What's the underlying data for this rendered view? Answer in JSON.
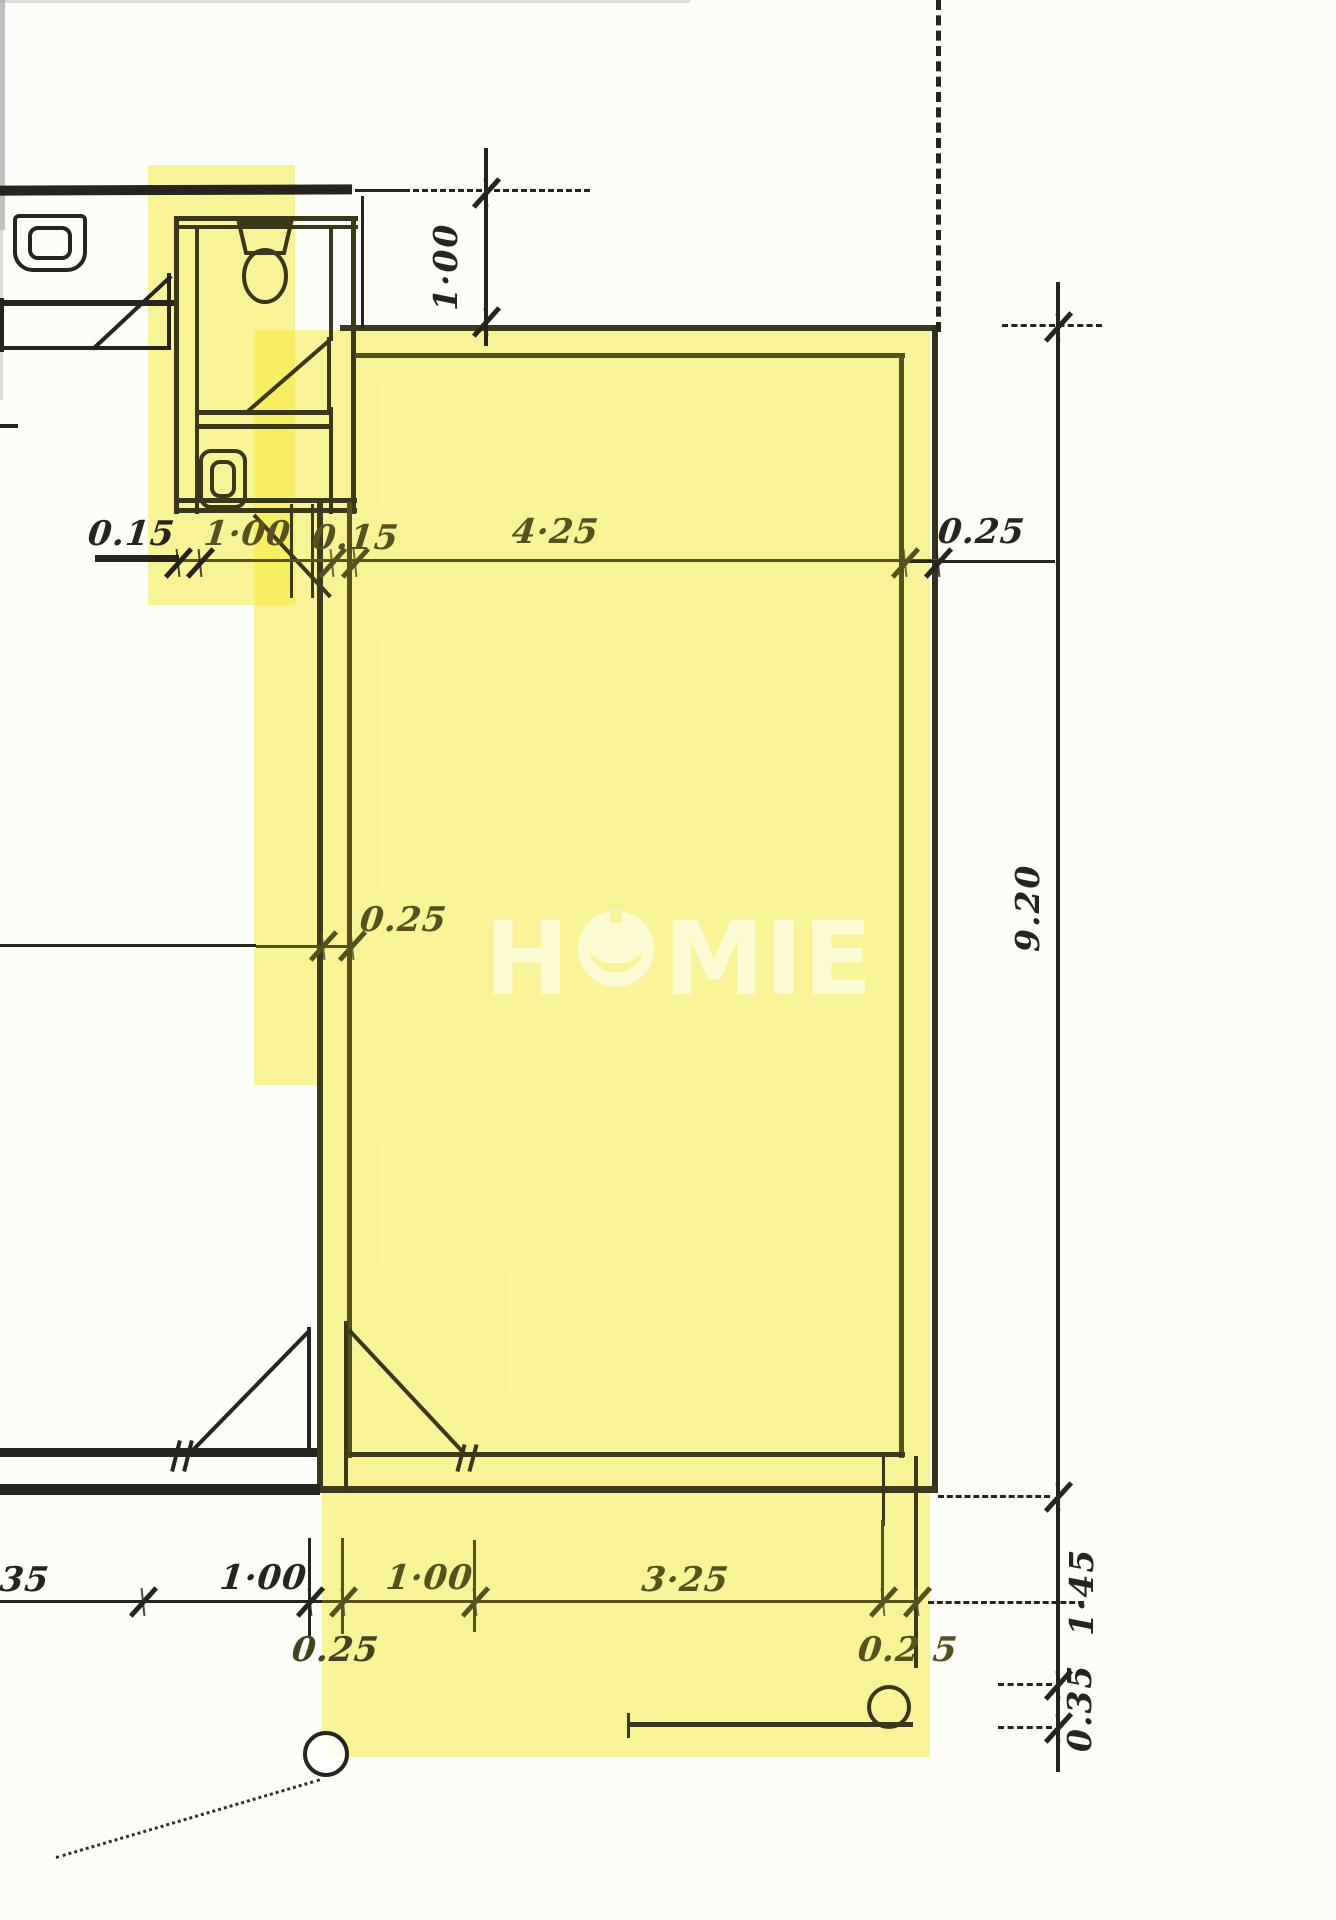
{
  "document": {
    "type": "floor-plan-sketch",
    "watermark": "HOMIE",
    "watermark_parts": [
      "H",
      "MIE"
    ]
  },
  "colors": {
    "highlight_yellow": "#f4ea2d",
    "ink_black": "#26241c",
    "ink_olive": "#55521f",
    "paper": "#fcfcf9",
    "watermark_white": "#ffffff"
  },
  "labels": {
    "dim_015_left": "0.15",
    "dim_100_wc": "1·00",
    "dim_015_right": "0.15",
    "dim_425": "4·25",
    "dim_025_rightwall": "0.25",
    "dim_100_top": "1·00",
    "dim_025_leftwall": "0.25",
    "dim_920": "9.20",
    "dim_145": "1·45",
    "dim_035": "0.35",
    "dim_35_bottom": "35",
    "dim_100_bottom_left": "1·00",
    "dim_025_bottom_left": "0.25",
    "dim_100_bottom_right": "1·00",
    "dim_325": "3·25",
    "dim_025_bottom_right": "0.2 5"
  }
}
